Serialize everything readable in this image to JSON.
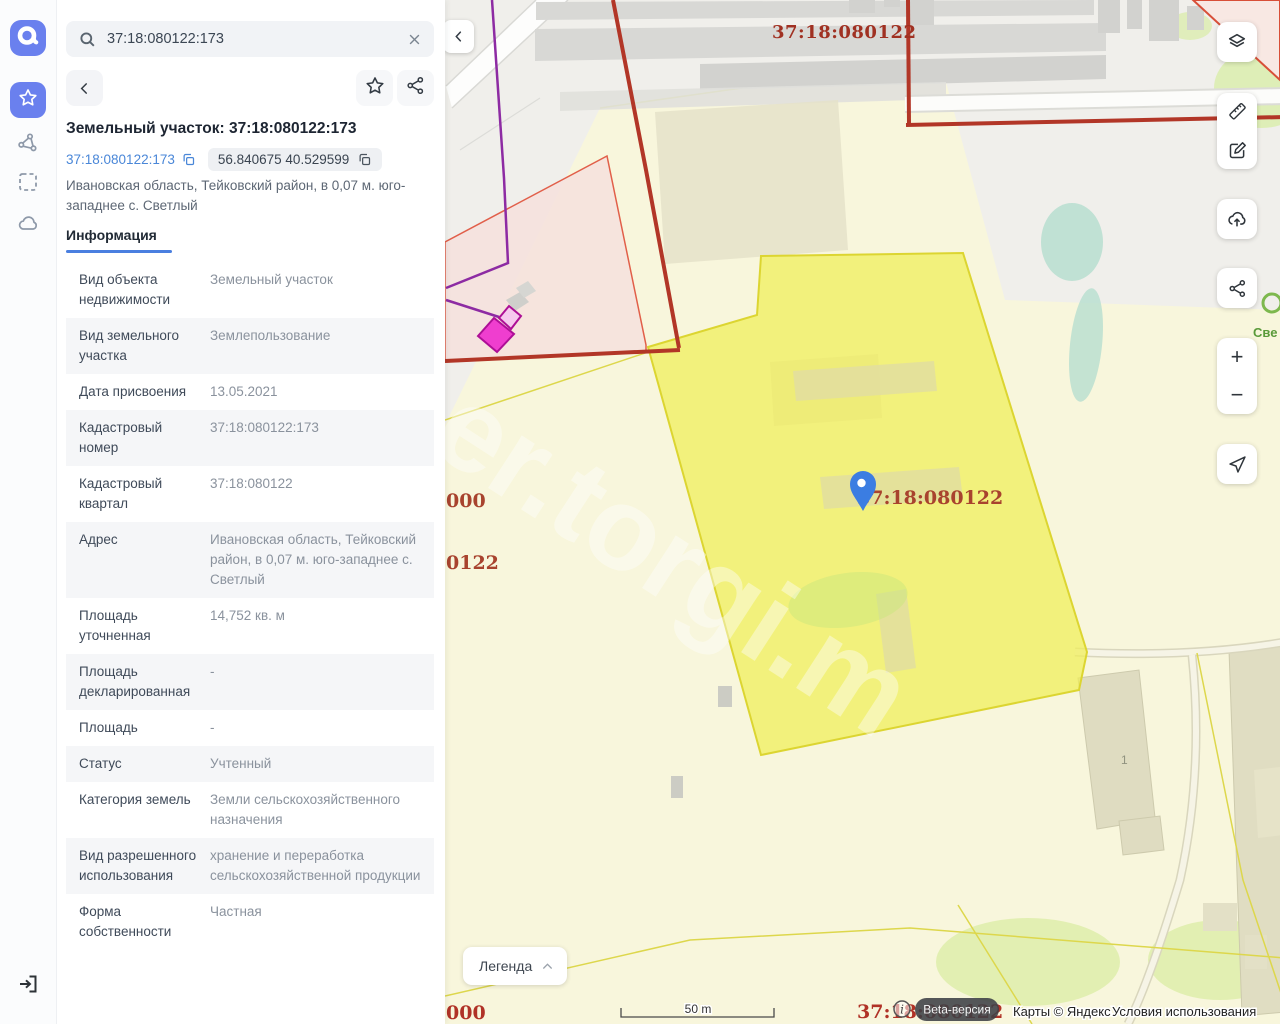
{
  "search": {
    "value": "37:18:080122:173"
  },
  "panel": {
    "title": "Земельный участок: 37:18:080122:173",
    "cadastral_chip": "37:18:080122:173",
    "coords_chip": "56.840675 40.529599",
    "address": "Ивановская область, Тейковский район, в 0,07 м. юго-западнее с. Светлый",
    "tab": "Информация",
    "rows": [
      {
        "label": "Вид объекта недвижимости",
        "value": "Земельный участок"
      },
      {
        "label": "Вид земельного участка",
        "value": "Землепользование"
      },
      {
        "label": "Дата присвоения",
        "value": "13.05.2021"
      },
      {
        "label": "Кадастровый номер",
        "value": "37:18:080122:173"
      },
      {
        "label": "Кадастровый квартал",
        "value": "37:18:080122"
      },
      {
        "label": "Адрес",
        "value": "Ивановская область, Тейковский район, в 0,07 м. юго-западнее с. Светлый"
      },
      {
        "label": "Площадь уточненная",
        "value": "14,752 кв. м"
      },
      {
        "label": "Площадь декларированная",
        "value": "-"
      },
      {
        "label": "Площадь",
        "value": "-"
      },
      {
        "label": "Статус",
        "value": "Учтенный"
      },
      {
        "label": "Категория земель",
        "value": "Земли сельскохозяйственного назначения"
      },
      {
        "label": "Вид разрешенного использования",
        "value": "хранение и переработка сельскохозяйственной продукции"
      },
      {
        "label": "Форма собственности",
        "value": "Частная"
      }
    ]
  },
  "map": {
    "quarter_label_top": "37:18:080122",
    "marker_label": "37:18:080122",
    "partial_label_left_1": "000",
    "partial_label_left_2": "0122",
    "partial_label_bottom_left": "000",
    "label_bottom_right": "37:18:080122",
    "village_label": "Све",
    "building_label": "1",
    "watermark": "er.torgi.m",
    "legend_button": "Легенда",
    "scale_label": "50 m",
    "beta_badge": "Beta-версия",
    "attribution_maps": "Карты © Яндекс",
    "attribution_terms": "Условия использования",
    "colors": {
      "accent_blue": "#6a80ee",
      "link_blue": "#4a87d8",
      "selected_parcel": "#f0ee58",
      "quarter_label_red": "#a33426",
      "marker_blue": "#3b7de2"
    }
  },
  "icons": [
    "app-logo",
    "favorites-star",
    "polygon-tool",
    "area-select",
    "cloud",
    "sign-in",
    "search",
    "clear",
    "back",
    "favorite",
    "share",
    "copy",
    "layers",
    "ruler",
    "edit",
    "cloud-upload",
    "zoom-in",
    "zoom-out",
    "locate",
    "legend-chevron",
    "info",
    "map-marker"
  ]
}
